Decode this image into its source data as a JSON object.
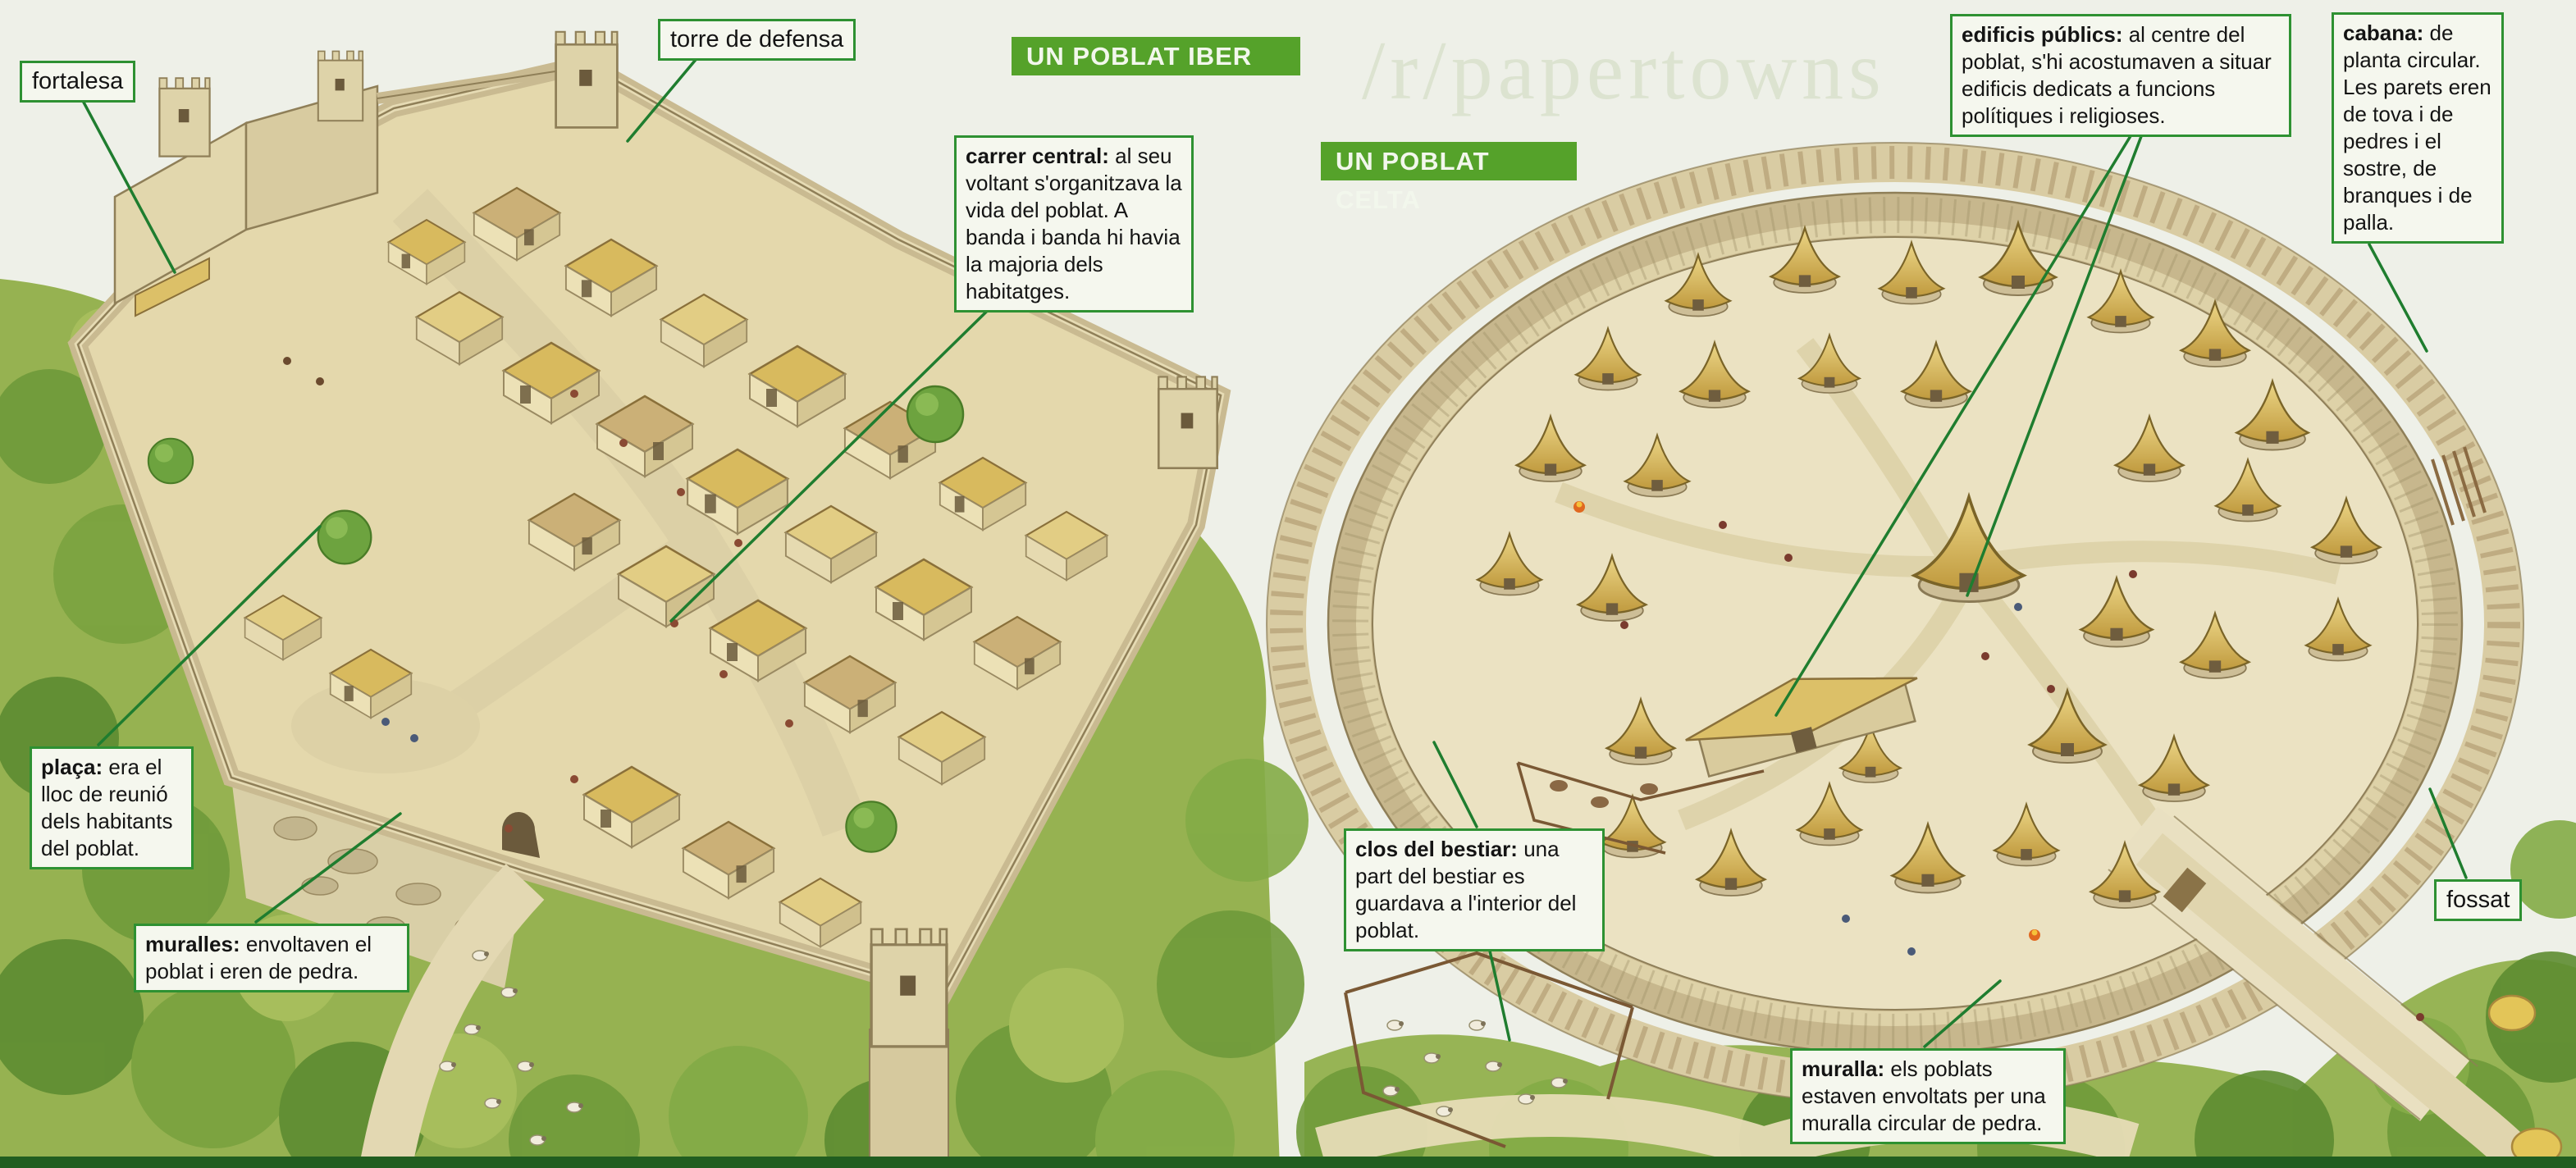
{
  "page": {
    "watermark": "/r/papertowns"
  },
  "colors": {
    "paper": "#eef0e8",
    "banner_green": "#55a22a",
    "label_border_green": "#2e9132",
    "label_background": "#f5f7ee",
    "leader_line_green": "#1f7d2f",
    "bottom_strip_green": "#215e20",
    "thatch_gold": "#d9b95c",
    "stone_tan": "#d9cda6",
    "vegetation_green": "#8fae4e"
  },
  "iber": {
    "banner": "UN POBLAT IBER",
    "fortalesa": "fortalesa",
    "torre": "torre de defensa",
    "carrer": {
      "bold": "carrer central:",
      "rest": " al seu voltant s'organitzava la vida del poblat. A banda i banda hi havia la majoria dels habitatges."
    },
    "placa": {
      "bold": "plaça:",
      "rest": " era el lloc de reunió dels habitants del poblat."
    },
    "muralles": {
      "bold": "muralles:",
      "rest": " envoltaven el poblat i eren de pedra."
    }
  },
  "celta": {
    "banner": "UN POBLAT CELTA",
    "edificis": {
      "bold": "edificis públics:",
      "rest": " al centre del poblat, s'hi acostumaven a situar edificis dedicats a funcions polítiques i religioses."
    },
    "cabana": {
      "bold": "cabana:",
      "rest": " de planta circular. Les parets eren de tova i de pedres i el sostre, de branques i de palla."
    },
    "clos": {
      "bold": "clos del bestiar:",
      "rest": " una part del bestiar es guardava a l'interior del poblat."
    },
    "muralla": {
      "bold": "muralla:",
      "rest": " els poblats estaven envoltats per una muralla circular de pedra."
    },
    "fossat": "fossat"
  }
}
